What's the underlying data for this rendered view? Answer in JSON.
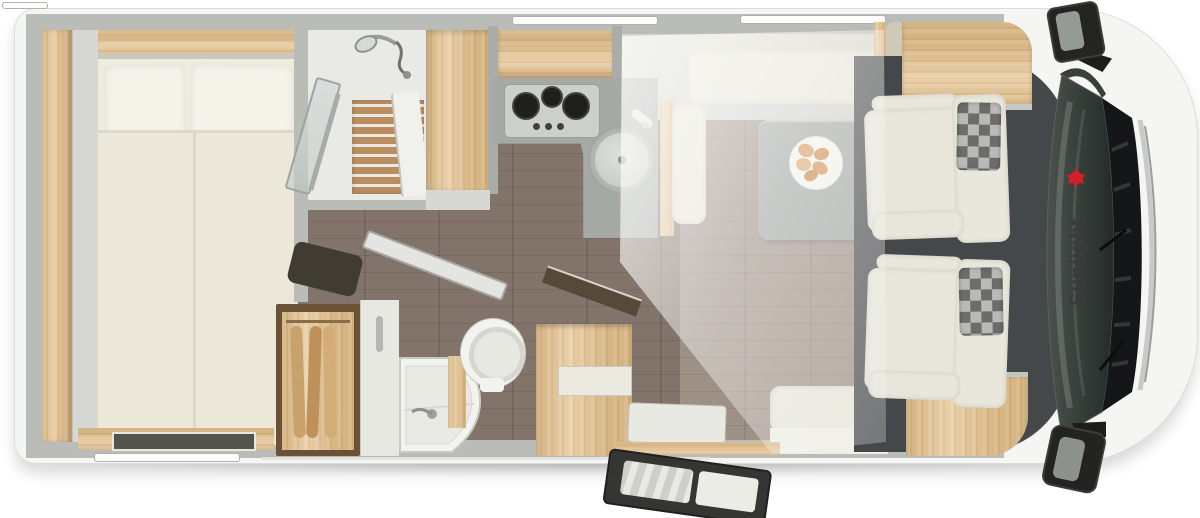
{
  "brand": {
    "name": "Sunlight",
    "logo_icon": "gecko-icon",
    "logo_text_color": "#3b3b3b",
    "logo_accent_color": "#cf2127"
  },
  "scene": {
    "type": "motorhome-floorplan-top-view",
    "background": "#ffffff"
  },
  "colors": {
    "body_white": "#f5f5f3",
    "wall_gray": "#b9bcb7",
    "wood_light": "#e3c392",
    "floor_brown": "#82746a",
    "counter_gray": "#a6aaa7",
    "upholstery_cream": "#e9e7db",
    "cab_floor_dark": "#45484a",
    "windshield_dark": "#2c332f"
  },
  "areas": [
    {
      "name": "rear-bedroom",
      "features": [
        "double-bed",
        "pillows",
        "side-shelf",
        "rear-window"
      ]
    },
    {
      "name": "shower-room",
      "features": [
        "shower-head",
        "wood-duckboard",
        "glass-door"
      ]
    },
    {
      "name": "wardrobe-cabinet",
      "features": []
    },
    {
      "name": "kitchen",
      "features": [
        "three-burner-hob",
        "round-sink",
        "l-shaped-worktop"
      ]
    },
    {
      "name": "washroom",
      "features": [
        "corner-basin",
        "toilet",
        "clothes-closet",
        "open-door"
      ]
    },
    {
      "name": "dinette",
      "features": [
        "bench-seats",
        "table",
        "plate-of-food",
        "drop-down-bed-overlay"
      ]
    },
    {
      "name": "entrance",
      "features": [
        "open-entry-door",
        "step"
      ]
    },
    {
      "name": "cab",
      "features": [
        "driver-seat",
        "passenger-seat",
        "windshield",
        "wing-mirrors",
        "sunlight-logo"
      ]
    }
  ]
}
